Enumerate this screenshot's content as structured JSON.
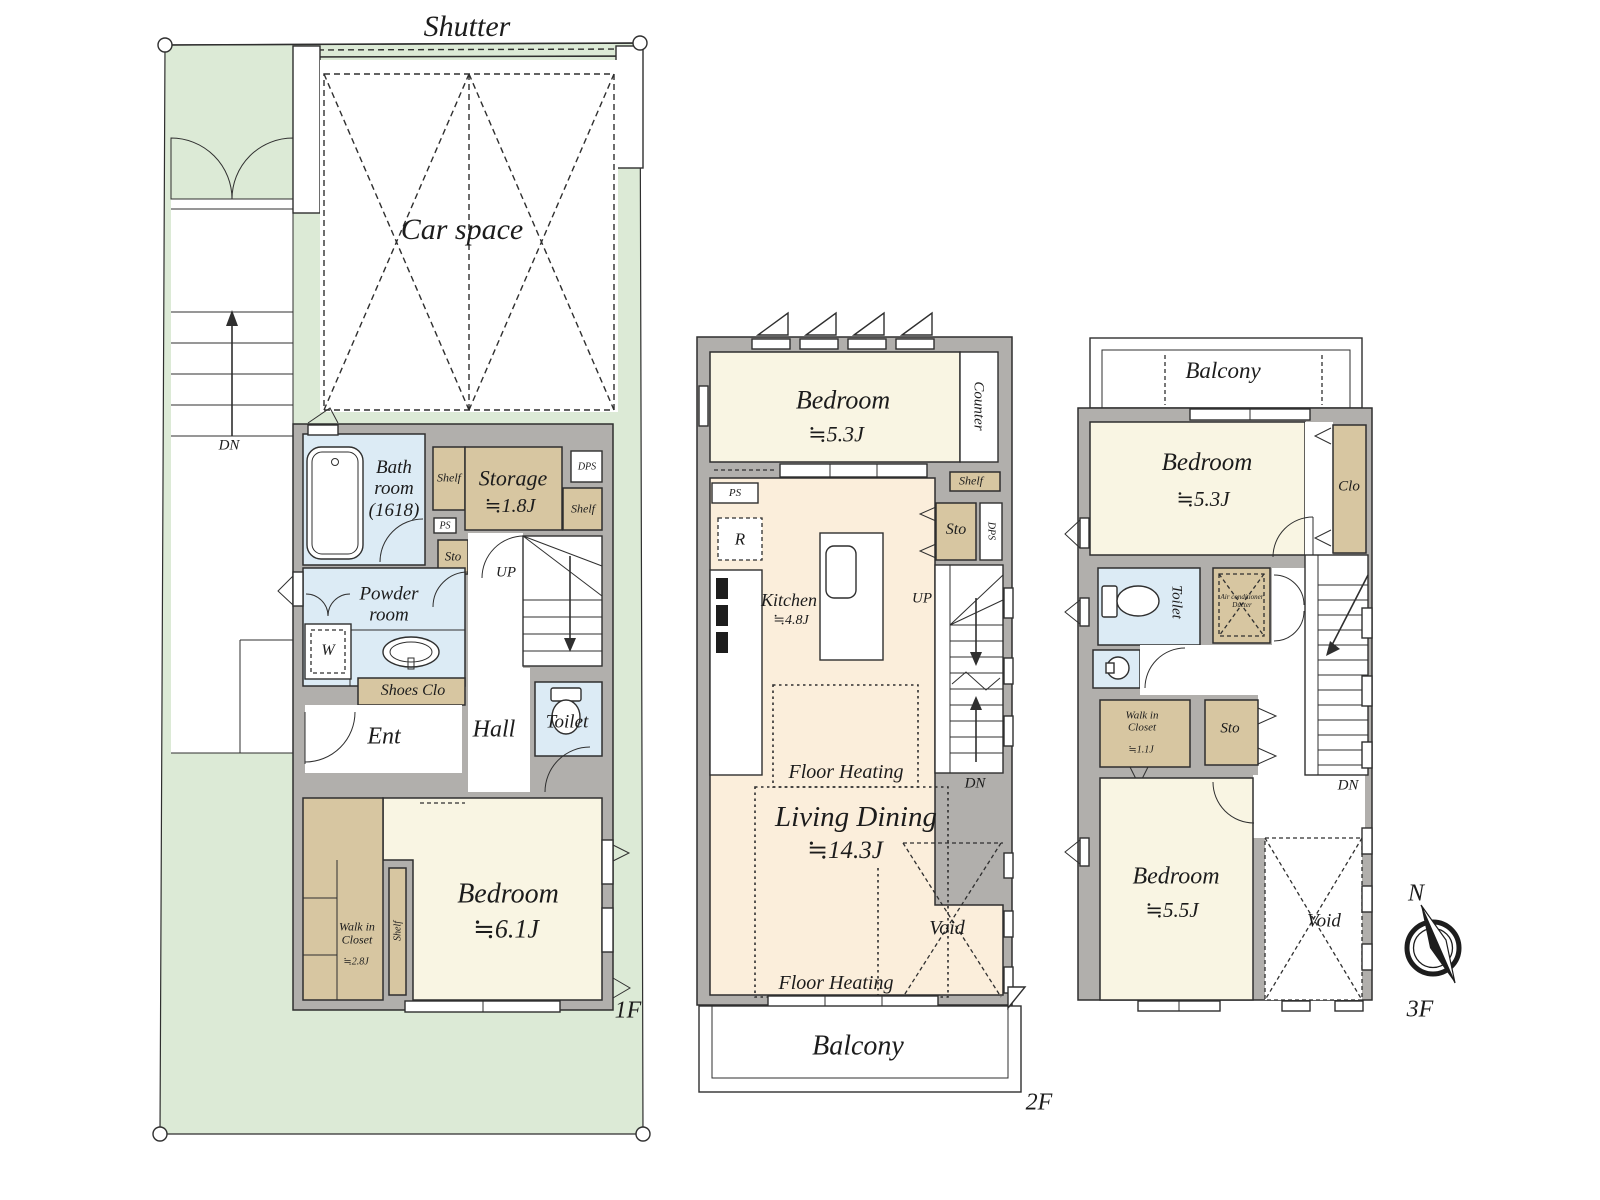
{
  "colors": {
    "green": "#dcead6",
    "wall": "#b1afac",
    "cream": "#f9f5e3",
    "peach": "#fbeedb",
    "blue": "#dcebf5",
    "tan": "#d7c6a1",
    "line": "#2f2f2f",
    "text": "#1c1c1c"
  },
  "f1": {
    "floor_label": "1F",
    "shutter": "Shutter",
    "car_space": "Car space",
    "dn": "DN",
    "bath": "Bath room (1618)",
    "shelf_a": "Shelf",
    "storage": "Storage",
    "storage_size": "≒1.8J",
    "dps": "DPS",
    "shelf_b": "Shelf",
    "ps": "PS",
    "sto": "Sto",
    "up": "UP",
    "powder": "Powder room",
    "w": "W",
    "shoes": "Shoes Clo",
    "ent": "Ent",
    "hall": "Hall",
    "toilet": "Toilet",
    "wic": "Walk in Closet",
    "wic_size": "≒2.8J",
    "shelf_c": "Shelf",
    "bedroom": "Bedroom",
    "bedroom_size": "≒6.1J"
  },
  "f2": {
    "floor_label": "2F",
    "bedroom": "Bedroom",
    "bedroom_size": "≒5.3J",
    "counter": "Counter",
    "shelf": "Shelf",
    "ps": "PS",
    "r": "R",
    "sto": "Sto",
    "dps": "DPS",
    "kitchen": "Kitchen",
    "kitchen_size": "≒4.8J",
    "up": "UP",
    "dn": "DN",
    "floor_heating_1": "Floor Heating",
    "living": "Living Dining",
    "living_size": "≒14.3J",
    "void": "Void",
    "floor_heating_2": "Floor Heating",
    "balcony": "Balcony"
  },
  "f3": {
    "floor_label": "3F",
    "balcony": "Balcony",
    "bedroom_a": "Bedroom",
    "bedroom_a_size": "≒5.3J",
    "clo": "Clo",
    "toilet": "Toilet",
    "ac_duct": "Air conditioner Ducter",
    "wic": "Walk in Closet",
    "wic_size": "≒1.1J",
    "sto": "Sto",
    "dn": "DN",
    "bedroom_b": "Bedroom",
    "bedroom_b_size": "≒5.5J",
    "void": "Void",
    "compass_n": "N"
  }
}
